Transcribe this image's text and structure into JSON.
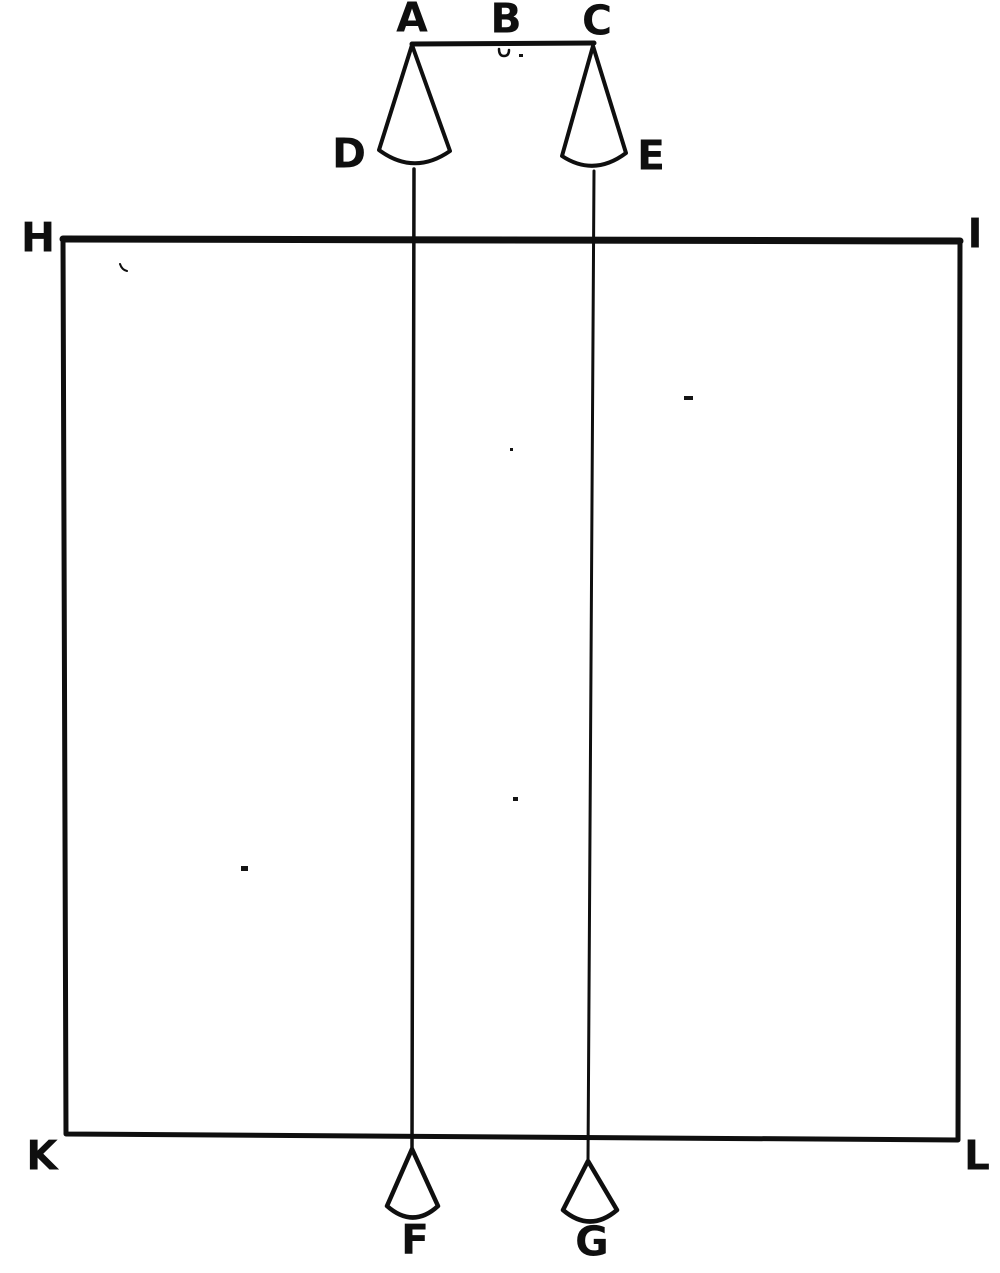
{
  "colors": {
    "ink": "#0f0f0f",
    "paper": "#ffffff"
  },
  "labels": {
    "a": "A",
    "b": "B",
    "c": "C",
    "d": "D",
    "e": "E",
    "f": "F",
    "g": "G",
    "h": "H",
    "i": "I",
    "k": "K",
    "l": "L"
  }
}
